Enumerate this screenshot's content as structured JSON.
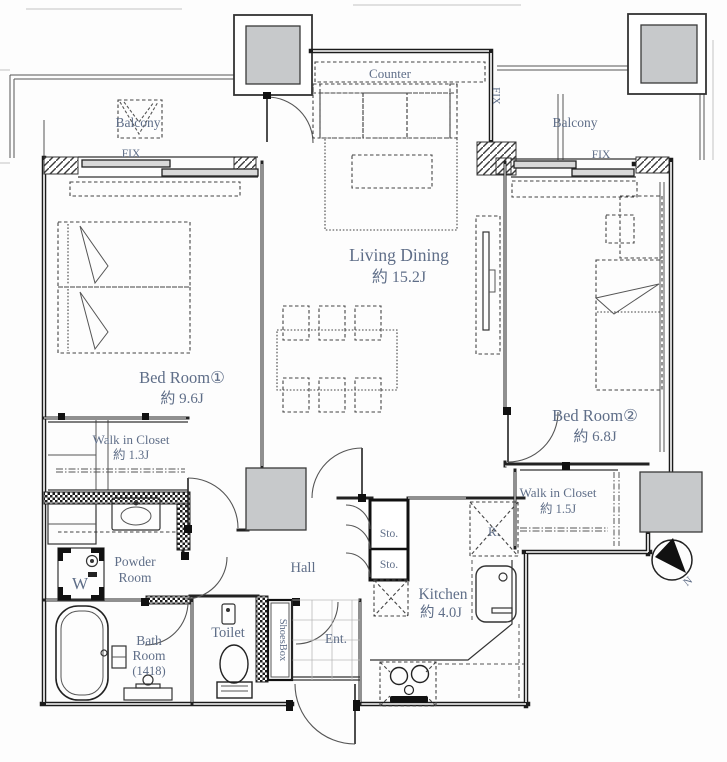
{
  "plan": {
    "rooms": {
      "living": {
        "name": "Living Dining",
        "size": "約 15.2J"
      },
      "bedroom1": {
        "name": "Bed Room①",
        "size": "約 9.6J"
      },
      "bedroom2": {
        "name": "Bed Room②",
        "size": "約 6.8J"
      },
      "wic1": {
        "name": "Walk in Closet",
        "size": "約 1.3J"
      },
      "wic2": {
        "name": "Walk in Closet",
        "size": "約 1.5J"
      },
      "powder": {
        "line1": "Powder",
        "line2": "Room"
      },
      "bath": {
        "line1": "Bath",
        "line2": "Room",
        "line3": "(1418)"
      },
      "toilet": {
        "name": "Toilet"
      },
      "hall": {
        "name": "Hall"
      },
      "kitchen": {
        "name": "Kitchen",
        "size": "約 4.0J"
      },
      "entrance": {
        "name": "Ent."
      }
    },
    "fixtures": {
      "counter": "Counter",
      "shoes_box": "ShoesBox",
      "storage1": "Sto.",
      "storage2": "Sto.",
      "refrigerator": "R.",
      "washer": "W",
      "balcony_left": "Balcony",
      "balcony_right": "Balcony",
      "fix_left": "FIX",
      "fix_right": "FIX",
      "fix_vertical": "FIX",
      "compass_north": "N"
    },
    "colors": {
      "label": "#5f6e88",
      "line": "#1b1b1b",
      "pillar_fill": "#c7c9cb"
    }
  }
}
